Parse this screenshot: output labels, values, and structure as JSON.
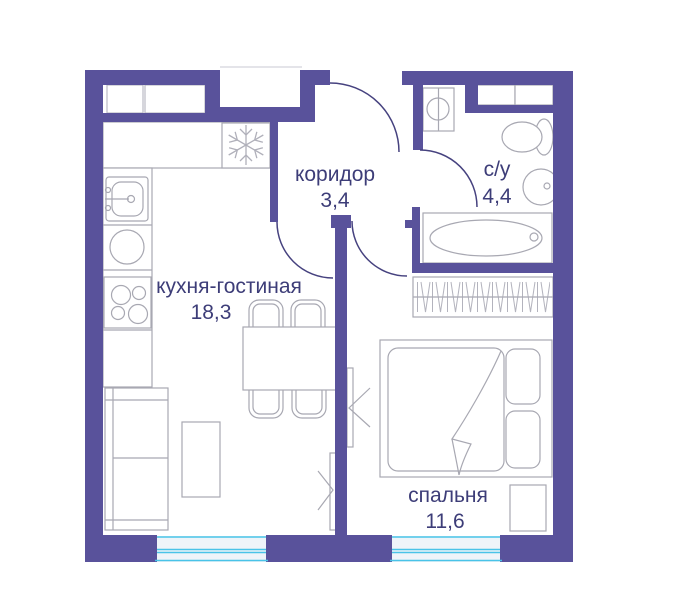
{
  "floorplan": {
    "type": "apartment-floor-plan",
    "rooms": [
      {
        "id": "corridor",
        "name": "коридор",
        "area": "3,4"
      },
      {
        "id": "bathroom",
        "name": "с/у",
        "area": "4,4"
      },
      {
        "id": "kitchen-living",
        "name": "кухня-гостиная",
        "area": "18,3"
      },
      {
        "id": "bedroom",
        "name": "спальня",
        "area": "11,6"
      }
    ],
    "colors": {
      "wall": "#59529b",
      "door_arc": "#46427f",
      "fixture_outline": "#a8a8b2",
      "label_text": "#3d3d78",
      "window_glass_line": "#49c3e8",
      "window_fill": "#eef4f9"
    },
    "fixtures": [
      "refrigerator (snowflake)",
      "kitchen-sink",
      "round-burner",
      "cooktop-4-burners",
      "sofa",
      "coffee-table",
      "dining-table",
      "chair x4",
      "tv-panel x2",
      "washing-machine",
      "shelf-unit",
      "toilet",
      "washbasin",
      "bathtub",
      "wardrobe-hangers",
      "double-bed",
      "pillow x2",
      "blanket",
      "nightstand",
      "window x2",
      "door-swing x4"
    ]
  }
}
